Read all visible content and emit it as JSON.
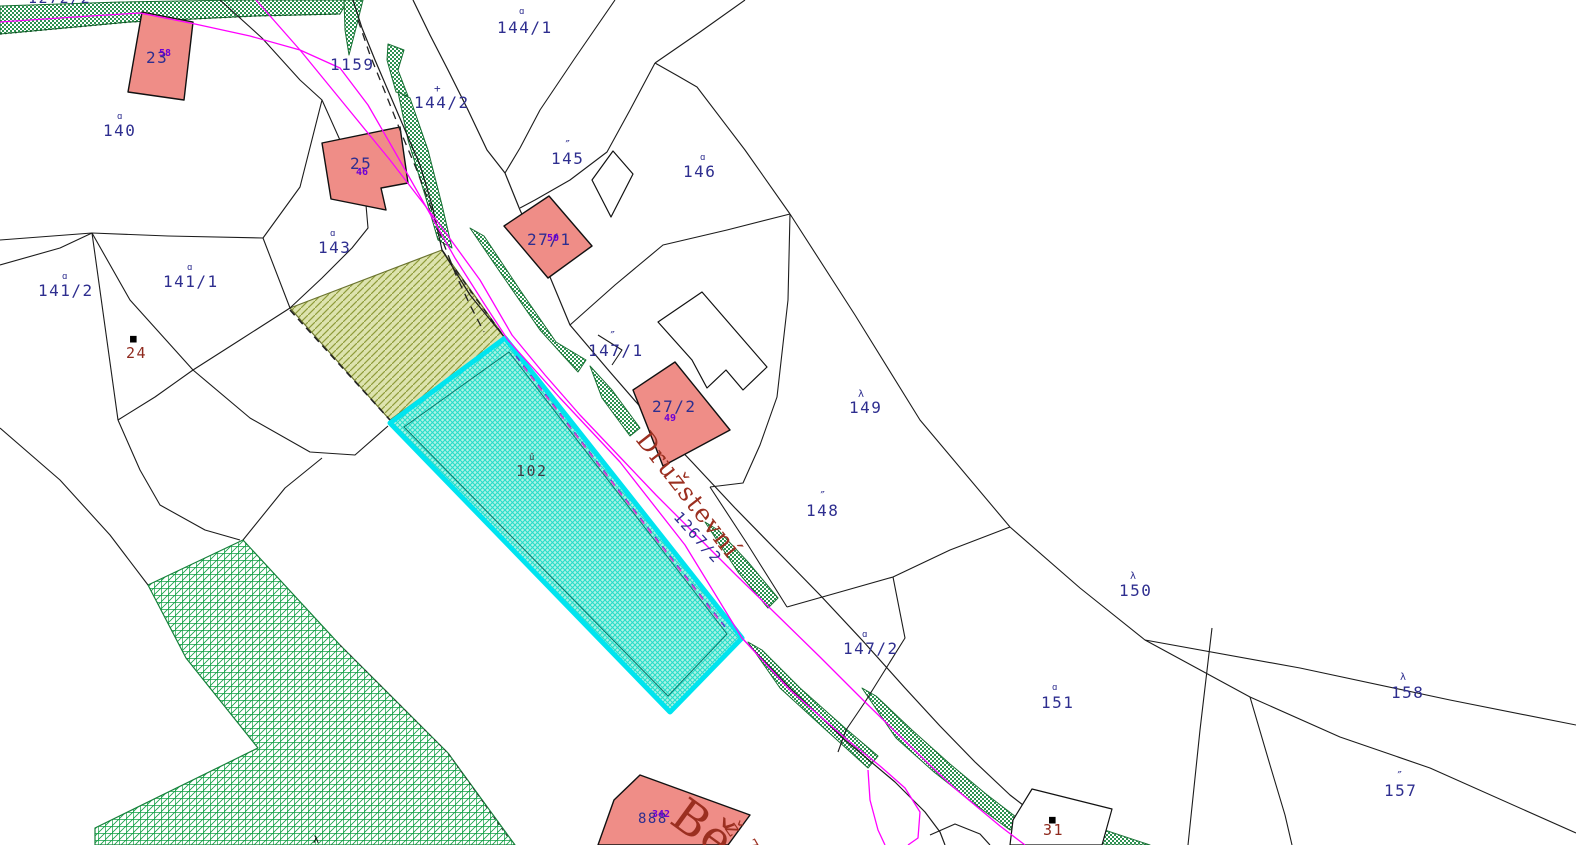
{
  "app": {
    "title": "Cadastral map view",
    "selected_parcel": "102"
  },
  "colors": {
    "parcel_number": "#2e2e8f",
    "building_number": "#6d00d6",
    "red_number": "#8f2a1e",
    "street_name": "#9b2f20",
    "selected_label": "#3f3f46",
    "boundary_line": "#1c1c1c",
    "overlay_magenta": "#ff00ff",
    "selected_border": "#00e4ef",
    "selected_fill_bg": "#aef2e4",
    "selected_fill_hatch": "#27ddc9",
    "olive_fill_bg": "#dde3ae",
    "olive_fill_hatch": "#8f9c3b",
    "road_green_fill": "#2c9150",
    "forest_grid_green": "#12a045",
    "building_fill": "#ef8d87",
    "white_building_fill": "#ffffff"
  },
  "labels": [
    {
      "text": "1272/2",
      "x": 28,
      "y": 3,
      "cls": "navy",
      "size": 15
    },
    {
      "text": "23",
      "x": 146,
      "y": 63,
      "cls": "navy",
      "size": 16
    },
    {
      "text": "140",
      "x": 103,
      "y": 136,
      "cls": "navy",
      "size": 16
    },
    {
      "text": "1159",
      "x": 330,
      "y": 70,
      "cls": "navy",
      "size": 16
    },
    {
      "text": "144/1",
      "x": 497,
      "y": 33,
      "cls": "navy",
      "size": 16
    },
    {
      "text": "144/2",
      "x": 414,
      "y": 108,
      "cls": "navy",
      "size": 16
    },
    {
      "text": "25",
      "x": 350,
      "y": 169,
      "cls": "navy",
      "size": 16
    },
    {
      "text": "143",
      "x": 318,
      "y": 253,
      "cls": "navy",
      "size": 16
    },
    {
      "text": "141/2",
      "x": 38,
      "y": 296,
      "cls": "navy",
      "size": 16
    },
    {
      "text": "141/1",
      "x": 163,
      "y": 287,
      "cls": "navy",
      "size": 16
    },
    {
      "text": "24",
      "x": 126,
      "y": 358,
      "cls": "red",
      "size": 15
    },
    {
      "text": "27/1",
      "x": 527,
      "y": 245,
      "cls": "navy",
      "size": 16
    },
    {
      "text": "145",
      "x": 551,
      "y": 164,
      "cls": "navy",
      "size": 16
    },
    {
      "text": "146",
      "x": 683,
      "y": 177,
      "cls": "navy",
      "size": 16
    },
    {
      "text": "147/1",
      "x": 588,
      "y": 356,
      "cls": "navy",
      "size": 16
    },
    {
      "text": "27/2",
      "x": 652,
      "y": 412,
      "cls": "navy",
      "size": 16
    },
    {
      "text": "149",
      "x": 849,
      "y": 413,
      "cls": "navy",
      "size": 16
    },
    {
      "text": "148",
      "x": 806,
      "y": 516,
      "cls": "navy",
      "size": 16
    },
    {
      "text": "147/2",
      "x": 843,
      "y": 654,
      "cls": "navy",
      "size": 16
    },
    {
      "text": "150",
      "x": 1119,
      "y": 596,
      "cls": "navy",
      "size": 16
    },
    {
      "text": "151",
      "x": 1041,
      "y": 708,
      "cls": "navy",
      "size": 16
    },
    {
      "text": "158",
      "x": 1391,
      "y": 698,
      "cls": "navy",
      "size": 16
    },
    {
      "text": "157",
      "x": 1384,
      "y": 796,
      "cls": "navy",
      "size": 16
    },
    {
      "text": "31",
      "x": 1043,
      "y": 835,
      "cls": "red",
      "size": 15
    },
    {
      "text": "102",
      "x": 516,
      "y": 476,
      "cls": "gray",
      "size": 15
    },
    {
      "text": "888",
      "x": 638,
      "y": 823,
      "cls": "navy",
      "size": 14
    },
    {
      "text": "Družstevní",
      "x": 682,
      "y": 500,
      "cls": "street",
      "size": 25,
      "rot": 52,
      "anchor": "middle"
    },
    {
      "text": "1267/2",
      "x": 694,
      "y": 541,
      "cls": "navy",
      "size": 15,
      "rot": 48,
      "anchor": "middle"
    },
    {
      "text": "Bě",
      "x": 668,
      "y": 822,
      "cls": "street",
      "size": 46,
      "rot": 36
    },
    {
      "text": "ž",
      "x": 724,
      "y": 828,
      "cls": "street",
      "size": 22,
      "rot": 55
    },
    {
      "text": "7",
      "x": 744,
      "y": 843,
      "cls": "street",
      "size": 16,
      "rot": 60
    }
  ],
  "building_numbers": [
    {
      "text": "58",
      "x": 159,
      "y": 56
    },
    {
      "text": "46",
      "x": 356,
      "y": 175
    },
    {
      "text": "50",
      "x": 547,
      "y": 241
    },
    {
      "text": "49",
      "x": 664,
      "y": 421
    },
    {
      "text": "342",
      "x": 652,
      "y": 817
    }
  ],
  "symbols": [
    {
      "ch": "ɑ",
      "x": 117,
      "y": 119,
      "cls": "navy",
      "size": 9
    },
    {
      "ch": "ɑ",
      "x": 519,
      "y": 14,
      "cls": "navy",
      "size": 9
    },
    {
      "ch": "+",
      "x": 434,
      "y": 92,
      "cls": "navy",
      "size": 11
    },
    {
      "ch": "ɑ",
      "x": 330,
      "y": 236,
      "cls": "navy",
      "size": 9
    },
    {
      "ch": "ɑ",
      "x": 62,
      "y": 279,
      "cls": "navy",
      "size": 9
    },
    {
      "ch": "ɑ",
      "x": 187,
      "y": 270,
      "cls": "navy",
      "size": 9
    },
    {
      "ch": "■",
      "x": 130,
      "y": 342,
      "cls": "black",
      "size": 11
    },
    {
      "ch": "″",
      "x": 564,
      "y": 149,
      "cls": "navy",
      "size": 12
    },
    {
      "ch": "ɑ",
      "x": 700,
      "y": 160,
      "cls": "navy",
      "size": 9
    },
    {
      "ch": "″",
      "x": 609,
      "y": 340,
      "cls": "navy",
      "size": 12
    },
    {
      "ch": "λ",
      "x": 858,
      "y": 397,
      "cls": "navy",
      "size": 10
    },
    {
      "ch": "″",
      "x": 819,
      "y": 500,
      "cls": "navy",
      "size": 12
    },
    {
      "ch": "ɑ",
      "x": 862,
      "y": 637,
      "cls": "navy",
      "size": 9
    },
    {
      "ch": "λ",
      "x": 1130,
      "y": 579,
      "cls": "navy",
      "size": 10
    },
    {
      "ch": "ɑ",
      "x": 1052,
      "y": 690,
      "cls": "navy",
      "size": 9
    },
    {
      "ch": "λ",
      "x": 1400,
      "y": 680,
      "cls": "navy",
      "size": 10
    },
    {
      "ch": "″",
      "x": 1396,
      "y": 780,
      "cls": "navy",
      "size": 12
    },
    {
      "ch": "■",
      "x": 1049,
      "y": 823,
      "cls": "black",
      "size": 11
    },
    {
      "ch": "ű",
      "x": 529,
      "y": 460,
      "cls": "gray",
      "size": 9
    },
    {
      "ch": "λ",
      "x": 313,
      "y": 843,
      "cls": "black",
      "size": 10
    }
  ]
}
